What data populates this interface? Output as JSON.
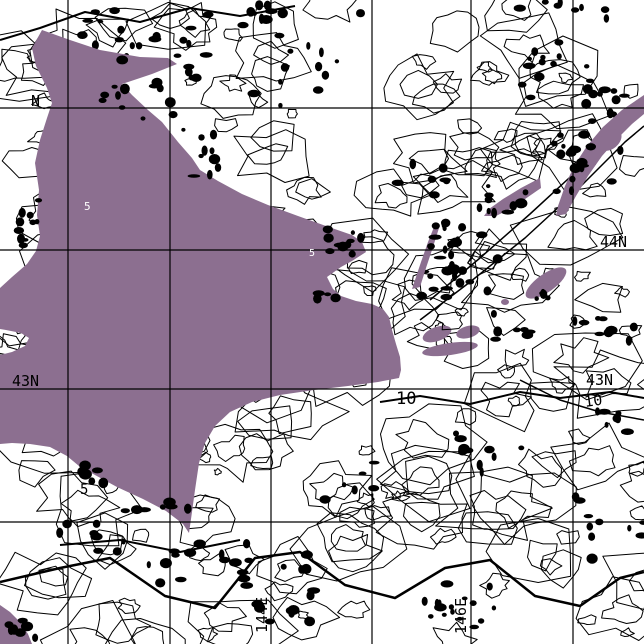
{
  "map": {
    "background_color": "#ffffff",
    "land_color": "#8c6f90",
    "line_color": "#000000",
    "graticule": {
      "h_lines": [
        {
          "y": 108,
          "name": "lat-line-45n"
        },
        {
          "y": 250,
          "name": "lat-line-44n"
        },
        {
          "y": 389,
          "name": "lat-line-43n"
        },
        {
          "y": 522,
          "name": "lat-line-42n"
        }
      ],
      "v_lines": [
        {
          "x": 68,
          "name": "lon-line-142e"
        },
        {
          "x": 170,
          "name": "lon-line-143e"
        },
        {
          "x": 271,
          "name": "lon-line-144e"
        },
        {
          "x": 372,
          "name": "lon-line-145e"
        },
        {
          "x": 471,
          "name": "lon-line-146e"
        },
        {
          "x": 573,
          "name": "lon-line-147e"
        }
      ]
    },
    "labels": [
      {
        "name": "lat-label-45n-left-partial",
        "text": "N",
        "x": 31,
        "y": 106,
        "size": 15,
        "color": "#000000",
        "rotate": 0
      },
      {
        "name": "lat-label-44n-right",
        "text": "44N",
        "x": 600,
        "y": 247,
        "size": 15,
        "color": "#000000",
        "rotate": 0
      },
      {
        "name": "lat-label-43n-left",
        "text": "43N",
        "x": 12,
        "y": 386,
        "size": 15,
        "color": "#000000",
        "rotate": 0
      },
      {
        "name": "lat-label-43n-right",
        "text": "43N",
        "x": 586,
        "y": 385,
        "size": 15,
        "color": "#000000",
        "rotate": 0
      },
      {
        "name": "lon-label-144e",
        "text": "144E",
        "x": 267,
        "y": 633,
        "size": 15,
        "color": "#000000",
        "rotate": -90
      },
      {
        "name": "lon-label-146e",
        "text": "146E",
        "x": 466,
        "y": 634,
        "size": 15,
        "color": "#000000",
        "rotate": -90
      },
      {
        "name": "contour-label-10-center",
        "text": "10",
        "x": 396,
        "y": 404,
        "size": 17,
        "color": "#000000",
        "rotate": 0
      },
      {
        "name": "contour-label-10-right",
        "text": "10",
        "x": 585,
        "y": 407,
        "size": 15,
        "color": "#000000",
        "rotate": -8
      },
      {
        "name": "contour-label-5-southwest",
        "text": "5",
        "x": 80,
        "y": 494,
        "size": 14,
        "color": "#000000",
        "rotate": 0
      },
      {
        "name": "contour-label-5-on-land-north",
        "text": "5",
        "x": 84,
        "y": 210,
        "size": 11,
        "color": "#ffffff",
        "rotate": 0
      },
      {
        "name": "contour-label-5-on-land-east",
        "text": "5",
        "x": 309,
        "y": 256,
        "size": 10,
        "color": "#ffffff",
        "rotate": 0
      }
    ]
  }
}
